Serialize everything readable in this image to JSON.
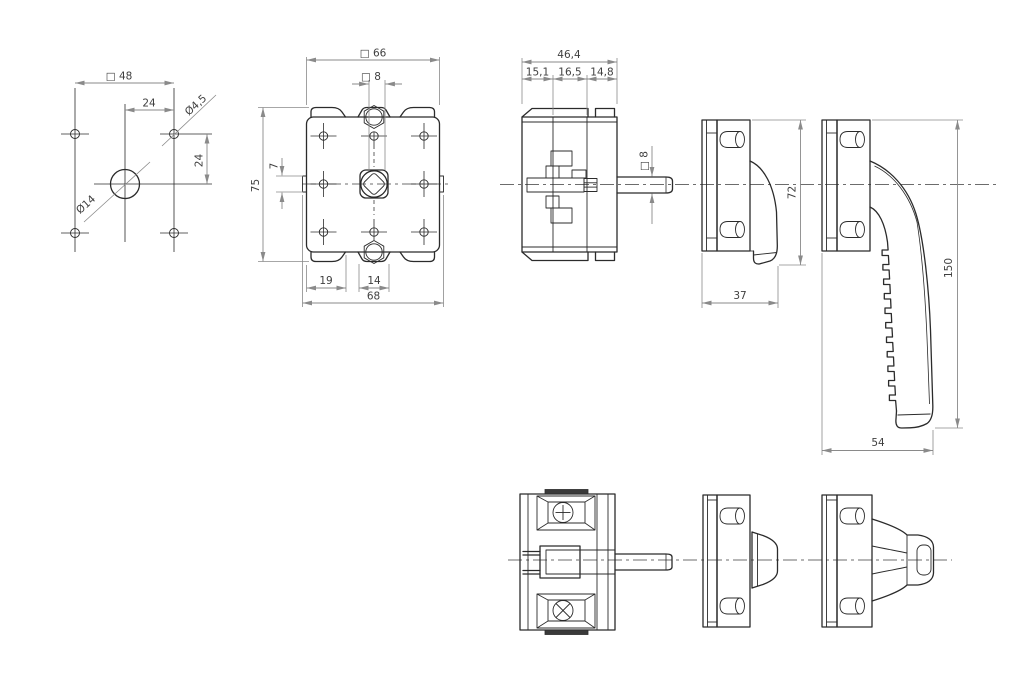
{
  "colors": {
    "background": "#ffffff",
    "outline": "#2b2b2b",
    "dimension_lines": "#8a8a8a",
    "dimension_text": "#3f3f3f"
  },
  "views": {
    "mounting_hole_pattern": {
      "square_48": "□ 48",
      "top_24": "24",
      "dia_4_5": "Ø4,5",
      "right_24": "24",
      "dia_14": "Ø14"
    },
    "switch_front": {
      "square_66": "□ 66",
      "square_8": "□ 8",
      "height_75": "75",
      "tab_7": "7",
      "bottom_19": "19",
      "bottom_14": "14",
      "width_68": "68"
    },
    "switch_side": {
      "depth_46_4": "46,4",
      "seg_15_1": "15,1",
      "seg_16_5": "16,5",
      "seg_14_8": "14,8",
      "shaft_square_8": "□ 8"
    },
    "handle_closed": {
      "height_72": "72",
      "depth_37": "37"
    },
    "handle_open": {
      "length_150": "150",
      "depth_54": "54"
    }
  }
}
